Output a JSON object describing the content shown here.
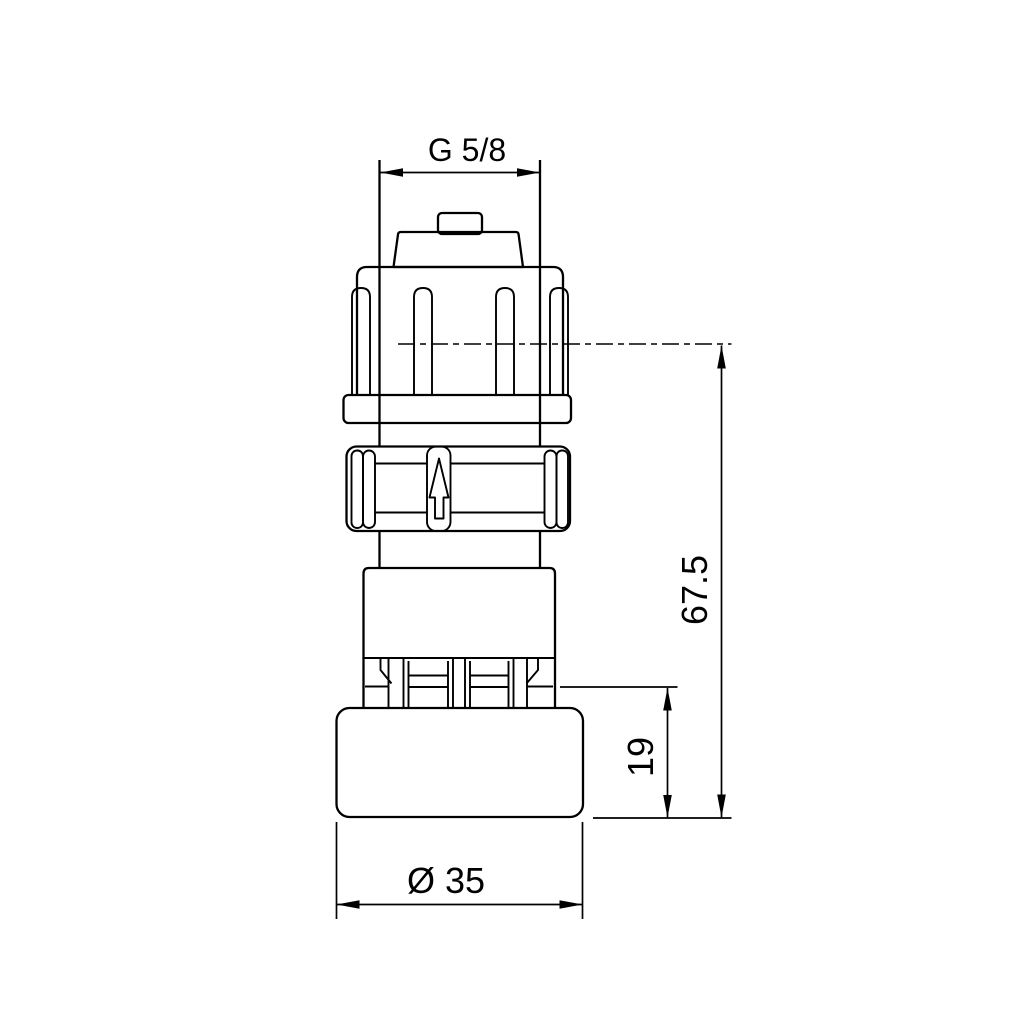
{
  "drawing": {
    "dimensions": {
      "thread_size": "G 5/8",
      "overall_height": "67.5",
      "lower_section_height": "19",
      "outer_diameter": "Ø 35"
    },
    "colors": {
      "line": "#000000",
      "background": "#ffffff"
    }
  }
}
